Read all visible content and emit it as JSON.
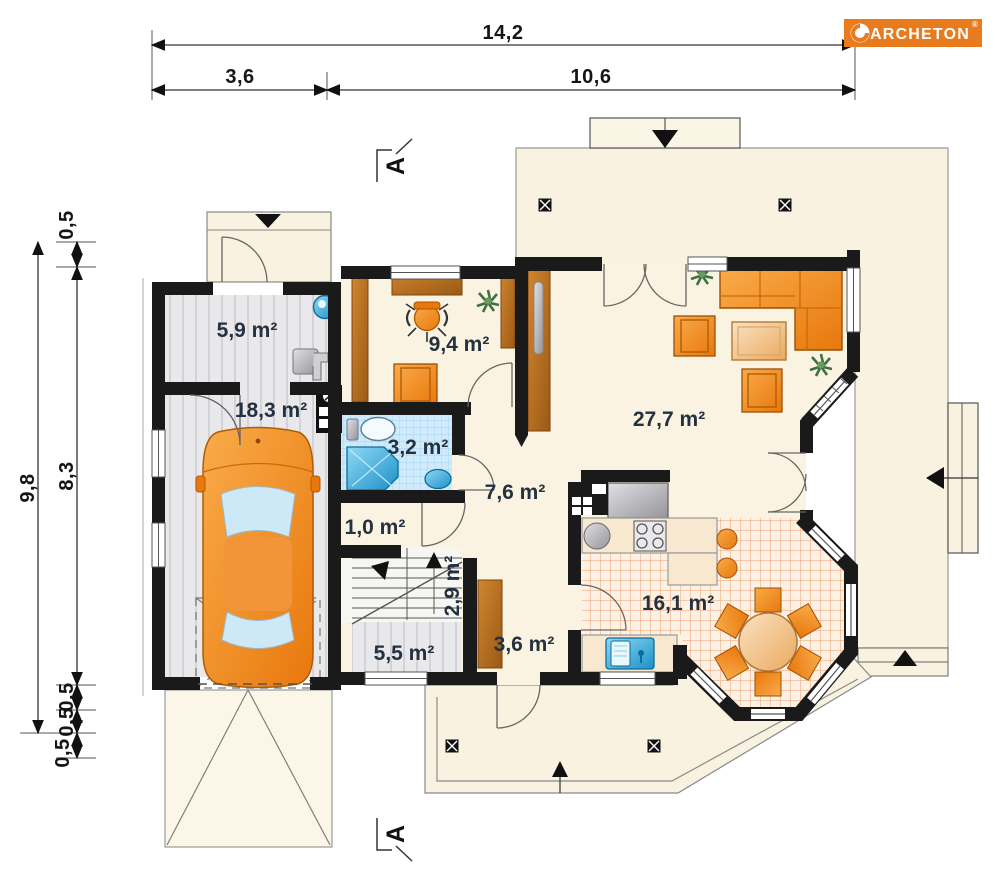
{
  "brand": {
    "name": "ARCHETON",
    "registered": "®"
  },
  "section_marker": {
    "label": "A"
  },
  "dimensions": {
    "top": {
      "overall": "14,2",
      "left_span": "3,6",
      "right_span": "10,6"
    },
    "left": {
      "overall": "9,8",
      "seg_top": "0,5",
      "seg_main": "8,3",
      "seg_b1": "0,5",
      "seg_b2": "0,5",
      "seg_b3": "0,5"
    }
  },
  "rooms": {
    "utility": {
      "area": "5,9 m²"
    },
    "garage": {
      "area": "18,3 m²"
    },
    "study": {
      "area": "9,4 m²"
    },
    "bathroom": {
      "area": "3,2 m²"
    },
    "hall": {
      "area": "7,6 m²"
    },
    "closet": {
      "area": "1,0 m²"
    },
    "stairs": {
      "area": "2,9 m²"
    },
    "storage": {
      "area": "5,5 m²"
    },
    "wardrobe": {
      "area": "3,6 m²"
    },
    "living": {
      "area": "27,7 m²"
    },
    "kitchen_dining": {
      "area": "16,1 m²"
    }
  },
  "palette": {
    "wall": "#1a1a1a",
    "floor": "#fbf3e1",
    "terrace": "#f9f2e0",
    "floor_gray": "#e9e9ec",
    "stripe": "#d2d2d7",
    "bath_tile": "#cfeafb",
    "bath_grid": "#a6d4ee",
    "kitchen_tile": "#fdf1e3",
    "kitchen_grid": "#eb9f72",
    "accent_orange": "#f08c1e",
    "accent_orange_dark": "#c96a0e",
    "wood": "#c07a36",
    "wood_dark": "#8f5317",
    "metal": "#c2c3c8",
    "water_blue": "#39a8dc",
    "label_color": "#243140",
    "dim_color": "#151515",
    "outline": "#8a8a8a",
    "logo_bg": "#e87b1e"
  }
}
